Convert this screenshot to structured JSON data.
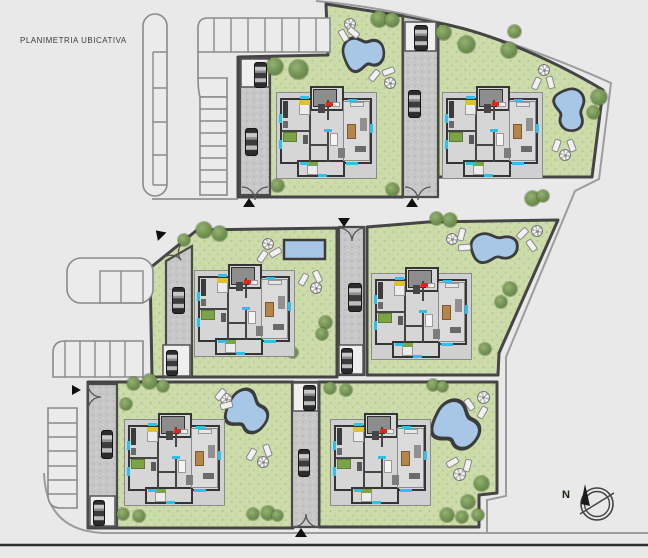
{
  "plan": {
    "title": "PLANIMETRIA UBICATIVA"
  },
  "compass": {
    "label": "N"
  },
  "palette": {
    "background": "#e9e9e9",
    "grass": "#ccdbaa",
    "tree": "#6d8e4e",
    "pool_water": "#a8c6e6",
    "pool_border": "#3c3c3c",
    "lot_wall": "#454545",
    "driveway": "#c7c7c7",
    "parking_line": "#8a8a8a",
    "road_line": "#2e2e2e",
    "house_wall": "#353535",
    "house_floor": "#d6d6d6",
    "window_accent": "#2fc0ea",
    "entry_accent": "#e02818",
    "bed_yellow": "#dcc22e",
    "bed_green": "#7ca447",
    "table_brown": "#b5854a"
  },
  "lots": [
    {
      "id": "villa-1",
      "position": "top-center",
      "pool": "kidney",
      "umbrellas": 2,
      "loungers": 4,
      "cars": 2
    },
    {
      "id": "villa-2",
      "position": "top-right",
      "pool": "kidney",
      "umbrellas": 2,
      "loungers": 4,
      "cars": 2
    },
    {
      "id": "villa-3",
      "position": "middle-left",
      "pool": "rectangular",
      "umbrellas": 2,
      "loungers": 4,
      "cars": 2
    },
    {
      "id": "villa-4",
      "position": "middle-right",
      "pool": "kidney",
      "umbrellas": 2,
      "loungers": 4,
      "cars": 2
    },
    {
      "id": "villa-5",
      "position": "bottom-left",
      "pool": "kidney",
      "umbrellas": 2,
      "loungers": 4,
      "cars": 2
    },
    {
      "id": "villa-6",
      "position": "bottom-right",
      "pool": "kidney",
      "umbrellas": 2,
      "loungers": 4,
      "cars": 2
    }
  ]
}
